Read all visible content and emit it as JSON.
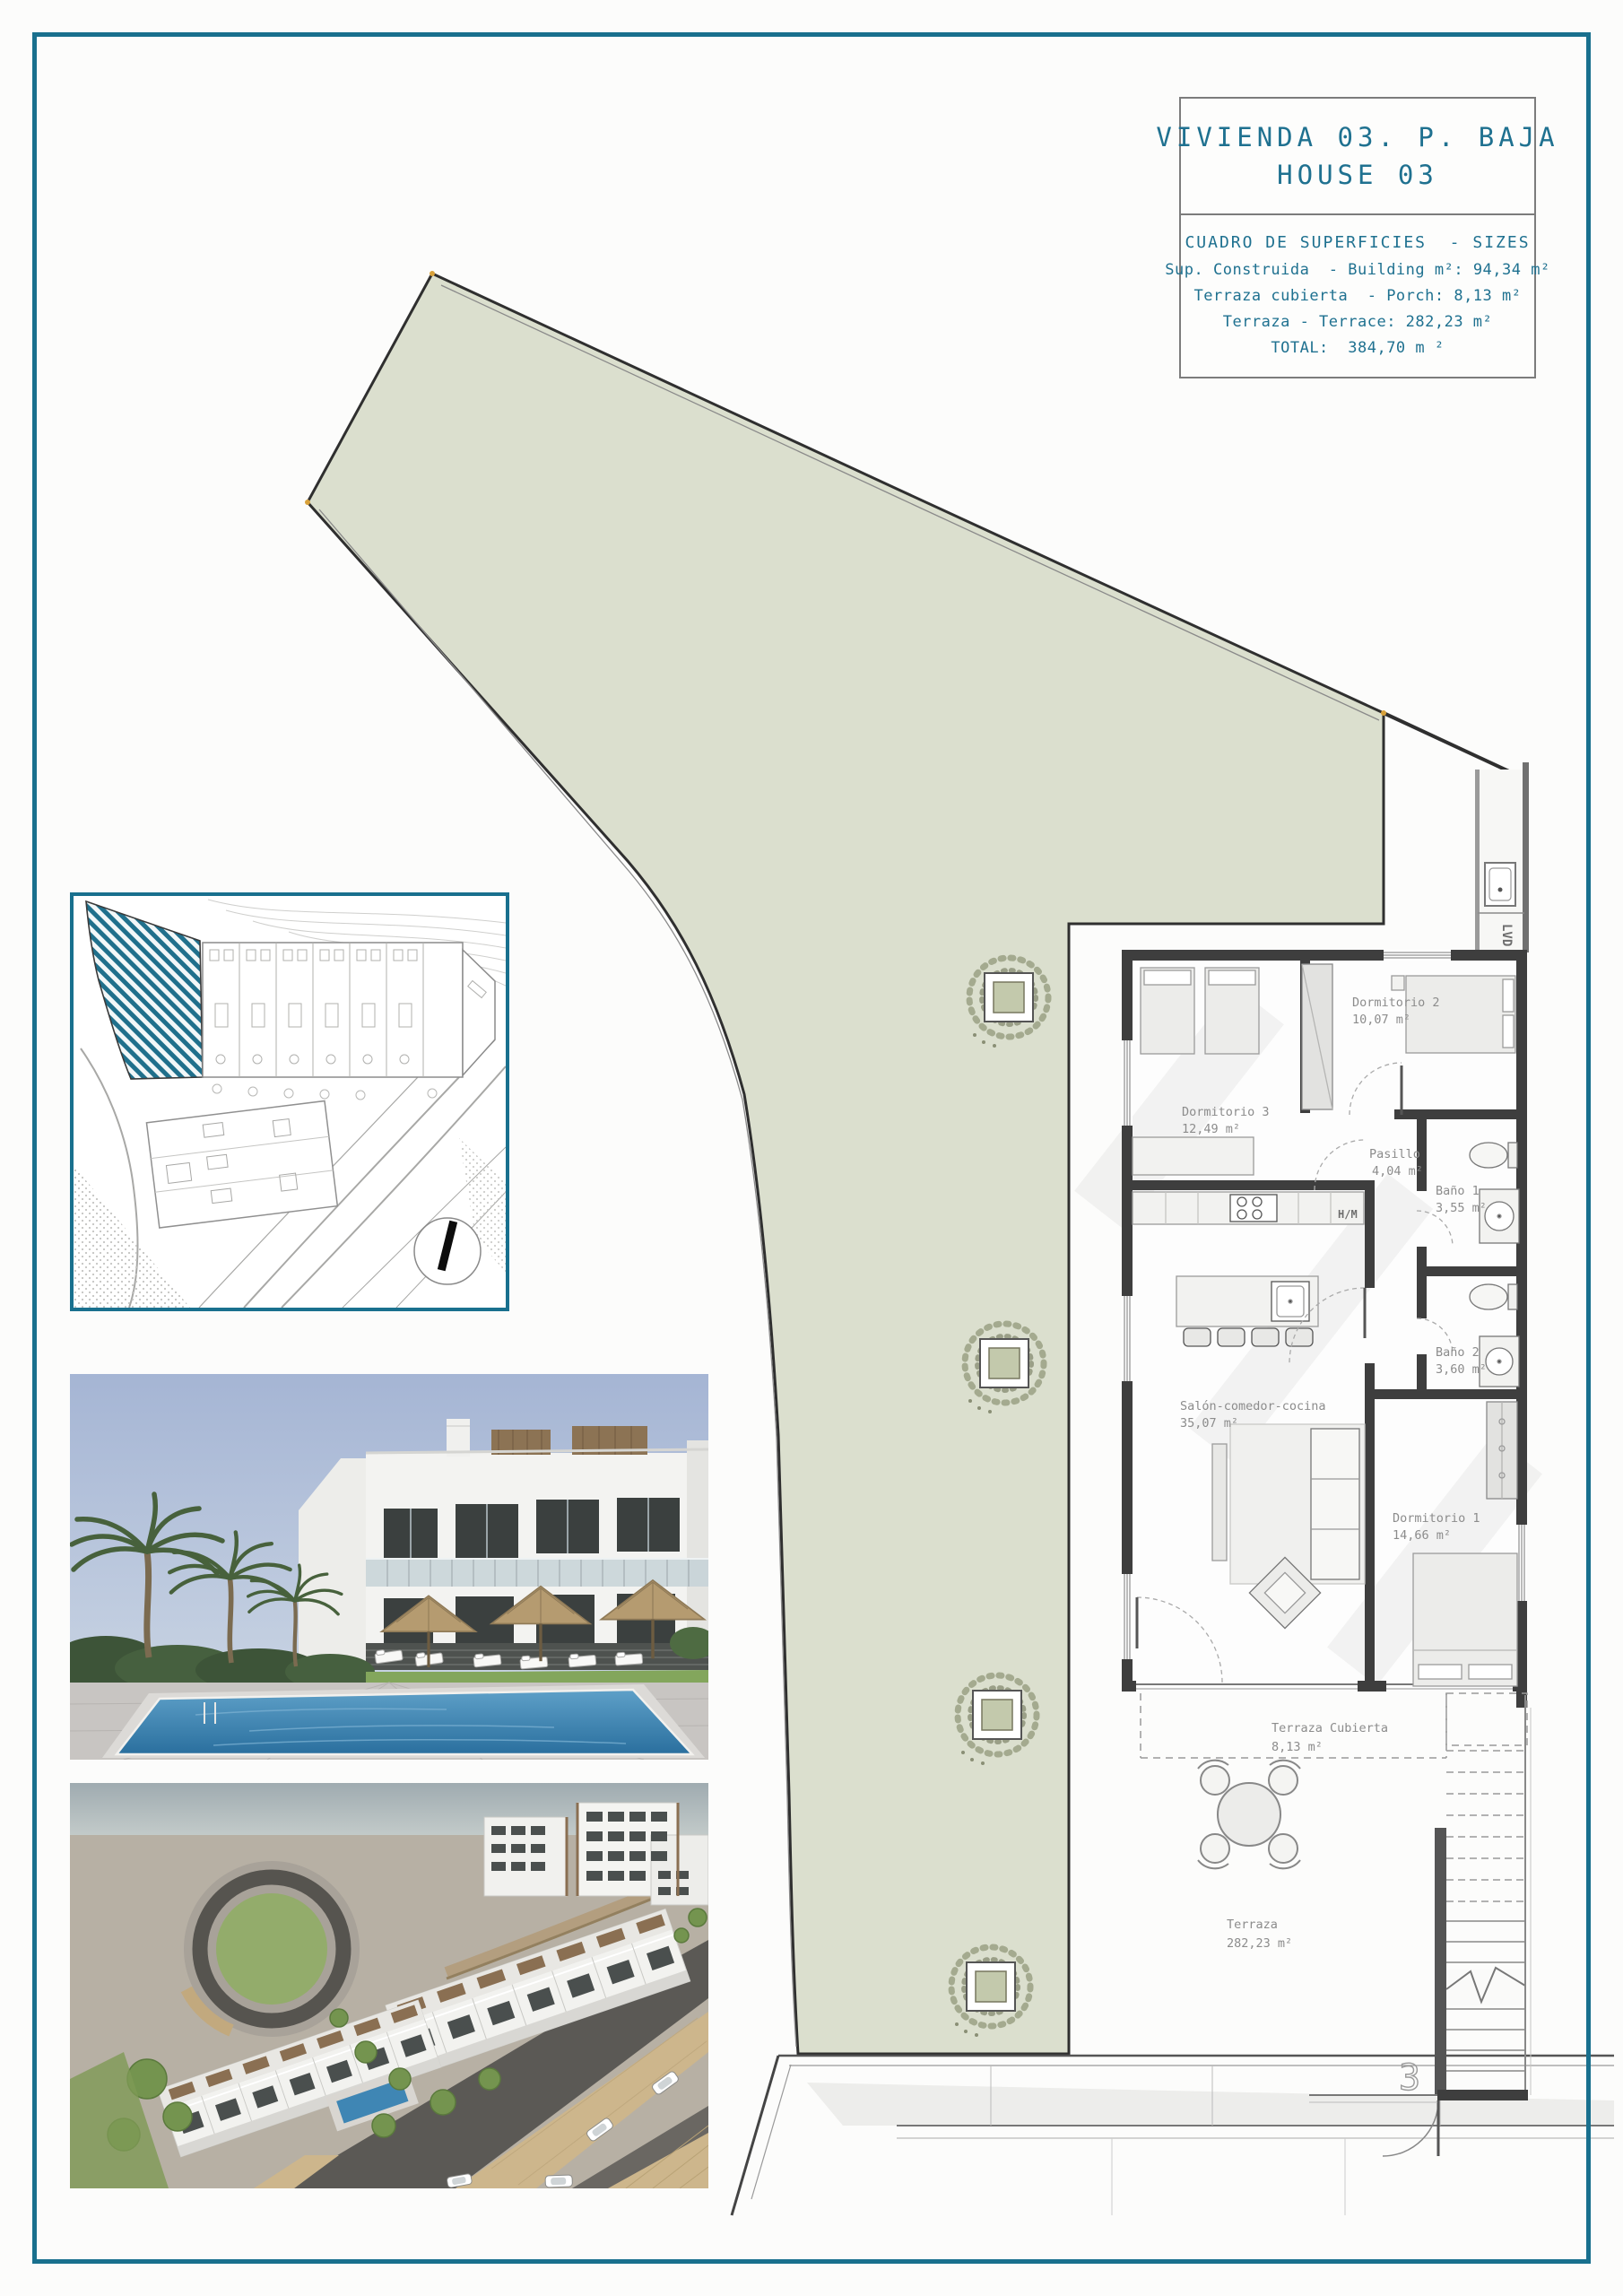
{
  "title_block": {
    "title_line1": "VIVIENDA 03. P. BAJA",
    "title_line2": "HOUSE 03",
    "sizes_heading": "CUADRO DE SUPERFICIES  - SIZES",
    "sizes": [
      "Sup. Construida  - Building m²: 94,34 m²",
      "Terraza cubierta  - Porch: 8,13 m²",
      "Terraza - Terrace: 282,23 m²",
      "TOTAL:  384,70 m ²"
    ]
  },
  "plan": {
    "rooms": [
      {
        "name": "Dormitorio 2",
        "area": "10,07 m²"
      },
      {
        "name": "Dormitorio 3",
        "area": "12,49 m²"
      },
      {
        "name": "Pasillo",
        "area": "4,04 m²"
      },
      {
        "name": "Baño 1",
        "area": "3,55 m²"
      },
      {
        "name": "Baño 2",
        "area": "3,60 m²"
      },
      {
        "name": "Salón-comedor-cocina",
        "area": "35,07 m²"
      },
      {
        "name": "Dormitorio 1",
        "area": "14,66 m²"
      },
      {
        "name": "Terraza Cubierta",
        "area": "8,13 m²"
      },
      {
        "name": "Terraza",
        "area": "282,23 m²"
      }
    ],
    "labels": {
      "lvd": "LVD",
      "hm": "H/M",
      "house_number": "3"
    }
  },
  "colors": {
    "accent_teal": "#19708e",
    "title_text": "#1f7190",
    "terrace_green": "#dbdfce",
    "wall_dark": "#3e3e3e",
    "label_gray": "#8c8c8c"
  }
}
